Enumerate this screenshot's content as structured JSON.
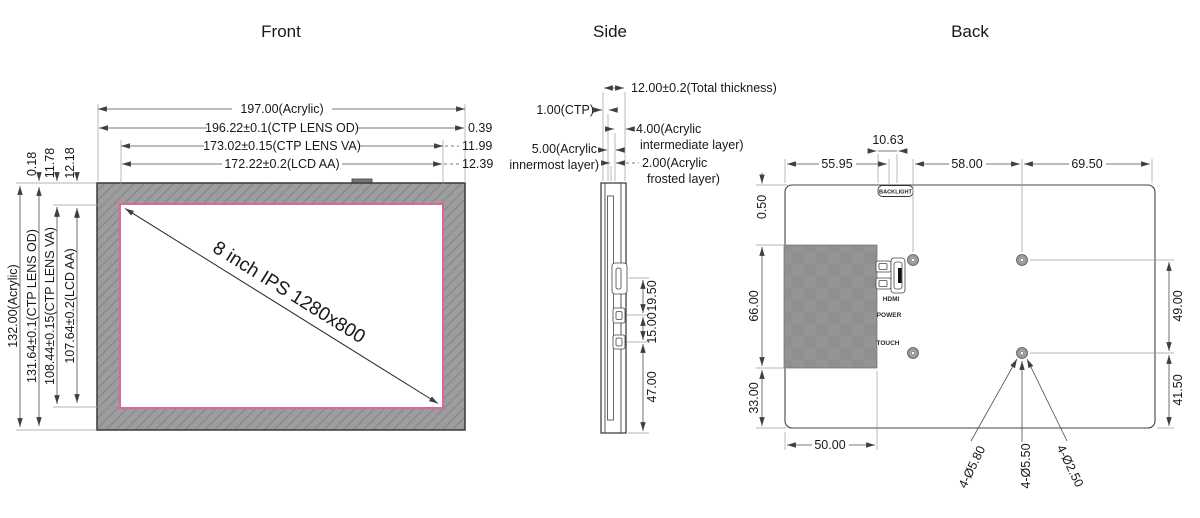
{
  "drawing": {
    "front": {
      "title": "Front",
      "screen_label": "8 inch IPS 1280x800",
      "dim_width_acrylic": "197.00(Acrylic)",
      "dim_width_ctp_od": "196.22±0.1(CTP LENS OD)",
      "dim_width_ctp_va": "173.02±0.15(CTP LENS VA)",
      "dim_width_lcd_aa": "172.22±0.2(LCD AA)",
      "offset_right_1": "0.39",
      "offset_right_2": "11.99",
      "offset_right_3": "12.39",
      "dim_height_acrylic": "132.00(Acrylic)",
      "dim_height_ctp_od": "131.64±0.1(CTP LENS OD)",
      "dim_height_ctp_va": "108.44±0.15(CTP LENS VA)",
      "dim_height_lcd_aa": "107.64±0.2(LCD AA)",
      "offset_top_1": "0.18",
      "offset_top_2": "11.78",
      "offset_top_3": "12.18"
    },
    "side": {
      "title": "Side",
      "dim_total": "12.00±0.2(Total thickness)",
      "dim_ctp": "1.00(CTP)",
      "dim_intermediate_l1": "4.00(Acrylic",
      "dim_intermediate_l2": "intermediate layer)",
      "dim_innermost_l1": "5.00(Acrylic",
      "dim_innermost_l2": "innermost layer)",
      "dim_frosted_l1": "2.00(Acrylic",
      "dim_frosted_l2": "frosted layer)",
      "dim_hdmi_offset": "19.50",
      "dim_usb_gap": "15.00",
      "dim_usb_bottom": "47.00"
    },
    "back": {
      "title": "Back",
      "backlight": "BACKLIGHT",
      "port_hdmi": "HDMI",
      "port_power": "POWER",
      "port_touch": "TOUCH",
      "dim_backlight_w": "10.63",
      "dim_top_left": "55.95",
      "dim_top_mid": "58.00",
      "dim_top_right": "69.50",
      "dim_lip": "0.50",
      "dim_board_h": "66.00",
      "dim_board_bottom": "33.00",
      "dim_board_w": "50.00",
      "dim_hole_v1": "49.00",
      "dim_hole_v2": "41.50",
      "callout_outer": "4-Ø5.80",
      "callout_mid": "4-Ø5.50",
      "callout_inner": "4-Ø2.50"
    },
    "colors": {
      "screen_border": "#e2639f",
      "bezel": "#9d9d9d",
      "line": "#4c4c4c"
    }
  }
}
